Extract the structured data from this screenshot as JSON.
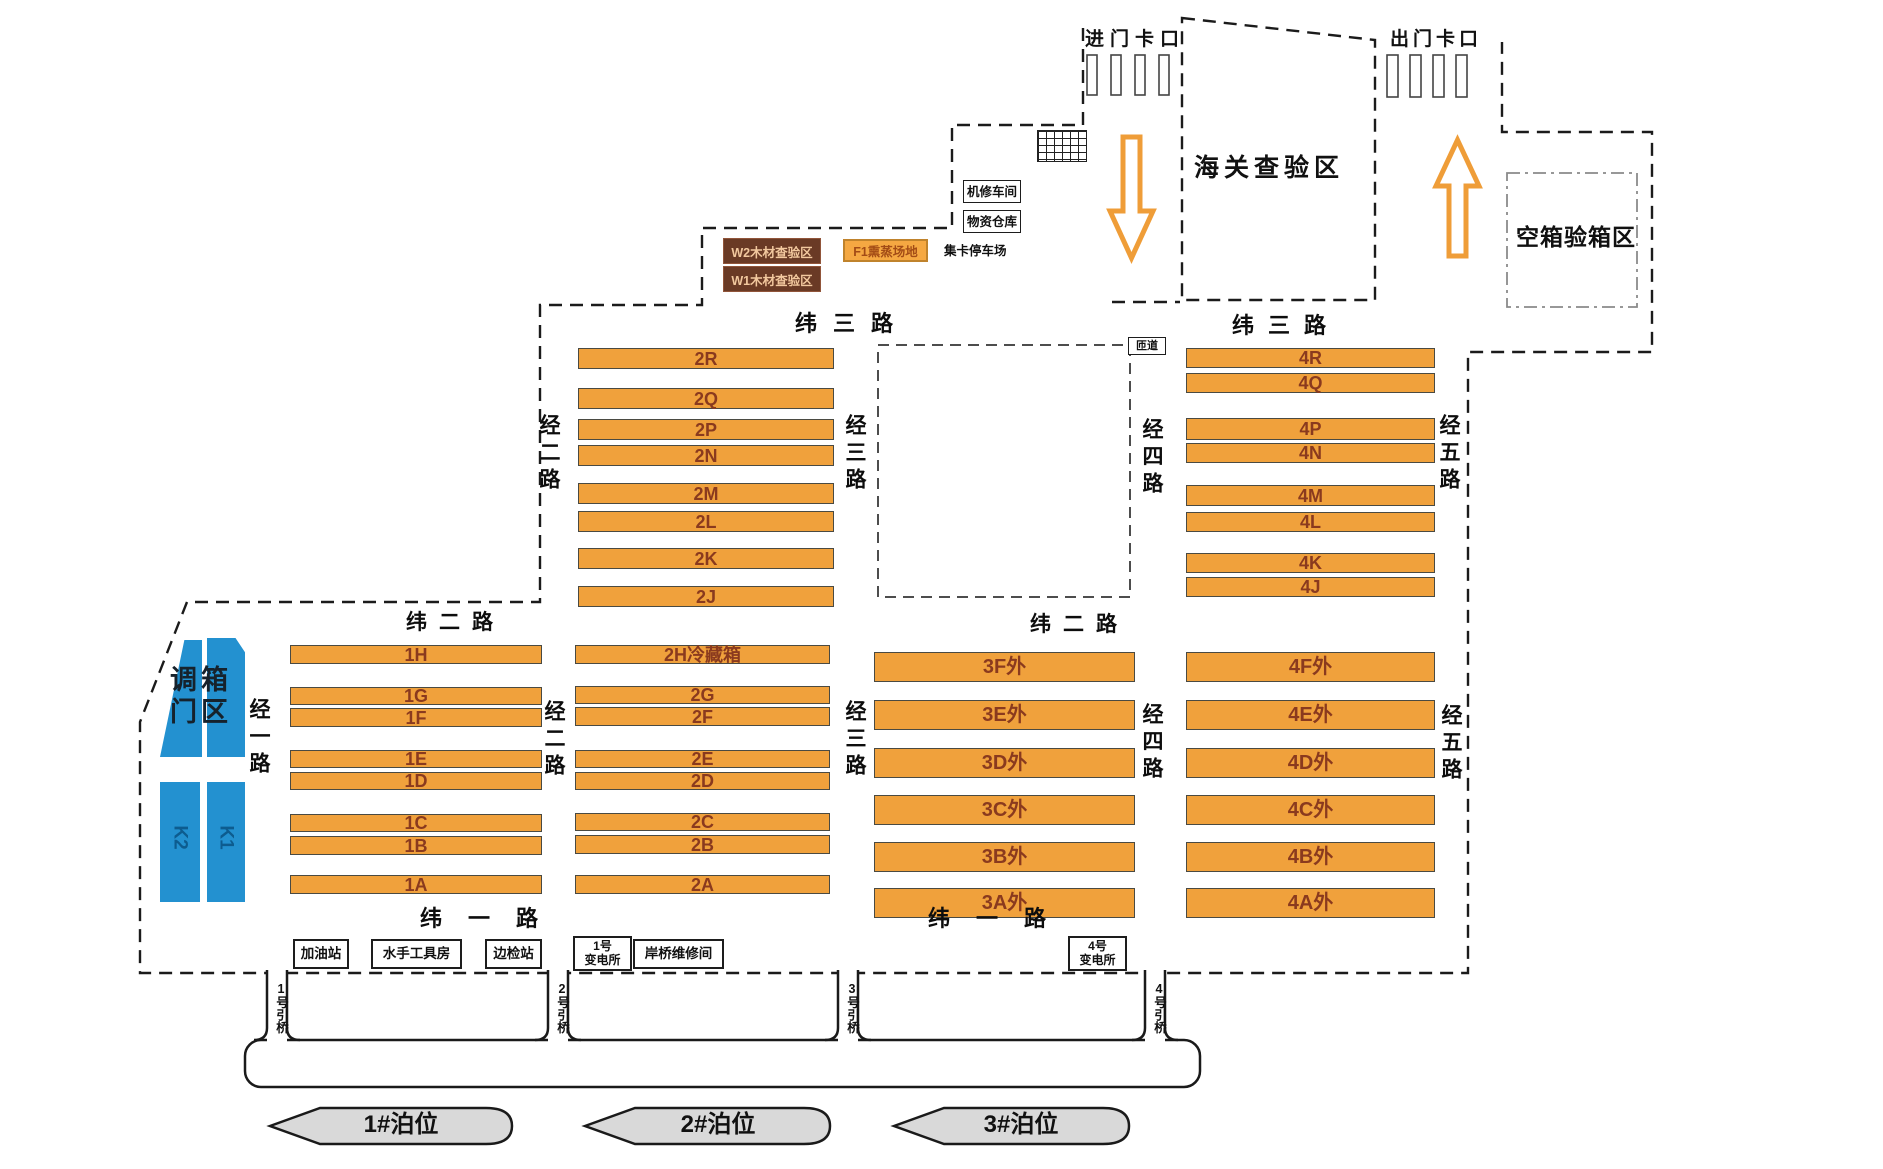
{
  "gates": {
    "entry": "进门卡口",
    "exit": "出门卡口"
  },
  "areas": {
    "customs": "海关查验区",
    "empty_container_inspection": "空箱验箱区",
    "truck_parking": "集卡停车场",
    "ramp": "匝道",
    "container_door_adjust": "调箱门区",
    "timber_inspection_w2": "W2木材查验区",
    "timber_inspection_w1": "W1木材查验区",
    "fumigation_f1": "F1熏蒸场地"
  },
  "facilities": {
    "machine_repair": "机修车间",
    "materials_warehouse": "物资仓库",
    "gas_station": "加油站",
    "sailor_toolroom": "水手工具房",
    "border_inspection": "边检站",
    "substation_1": "1号\n变电所",
    "crane_repair": "岸桥维修间",
    "substation_4": "4号\n变电所"
  },
  "roads": {
    "wei3_left": "纬三路",
    "wei3_right": "纬三路",
    "wei2_left": "纬二路",
    "wei2_right": "纬二路",
    "wei1_left": "纬一路",
    "wei1_right": "纬一路",
    "jing1": "经一路",
    "jing2_upper": "经二路",
    "jing2_lower": "经二路",
    "jing3_upper": "经三路",
    "jing3_lower": "经三路",
    "jing4_upper": "经四路",
    "jing4_lower": "经四路",
    "jing5_upper": "经五路",
    "jing5_lower": "经五路"
  },
  "blocks": {
    "block2_upper": [
      "2R",
      "2Q",
      "2P",
      "2N",
      "2M",
      "2L",
      "2K",
      "2J"
    ],
    "block4_upper": [
      "4R",
      "4Q",
      "4P",
      "4N",
      "4M",
      "4L",
      "4K",
      "4J"
    ],
    "block1": [
      "1H",
      "1G",
      "1F",
      "1E",
      "1D",
      "1C",
      "1B",
      "1A"
    ],
    "block2_lower": [
      "2H冷藏箱",
      "2G",
      "2F",
      "2E",
      "2D",
      "2C",
      "2B",
      "2A"
    ],
    "block3": [
      "3F外",
      "3E外",
      "3D外",
      "3C外",
      "3B外",
      "3A外"
    ],
    "block4_lower": [
      "4F外",
      "4E外",
      "4D外",
      "4C外",
      "4B外",
      "4A外"
    ]
  },
  "blue_bars": [
    "K2",
    "K1"
  ],
  "bridges": [
    "1号引桥",
    "2号引桥",
    "3号引桥",
    "4号引桥"
  ],
  "berths": [
    "1#泊位",
    "2#泊位",
    "3#泊位"
  ],
  "colors": {
    "bar_fill": "#F0A13C",
    "bar_text": "#8A3A1E",
    "blue": "#2391D0",
    "brown": "#6A3A25",
    "arrow": "#EF9D38",
    "ship": "#D9D9D9"
  }
}
